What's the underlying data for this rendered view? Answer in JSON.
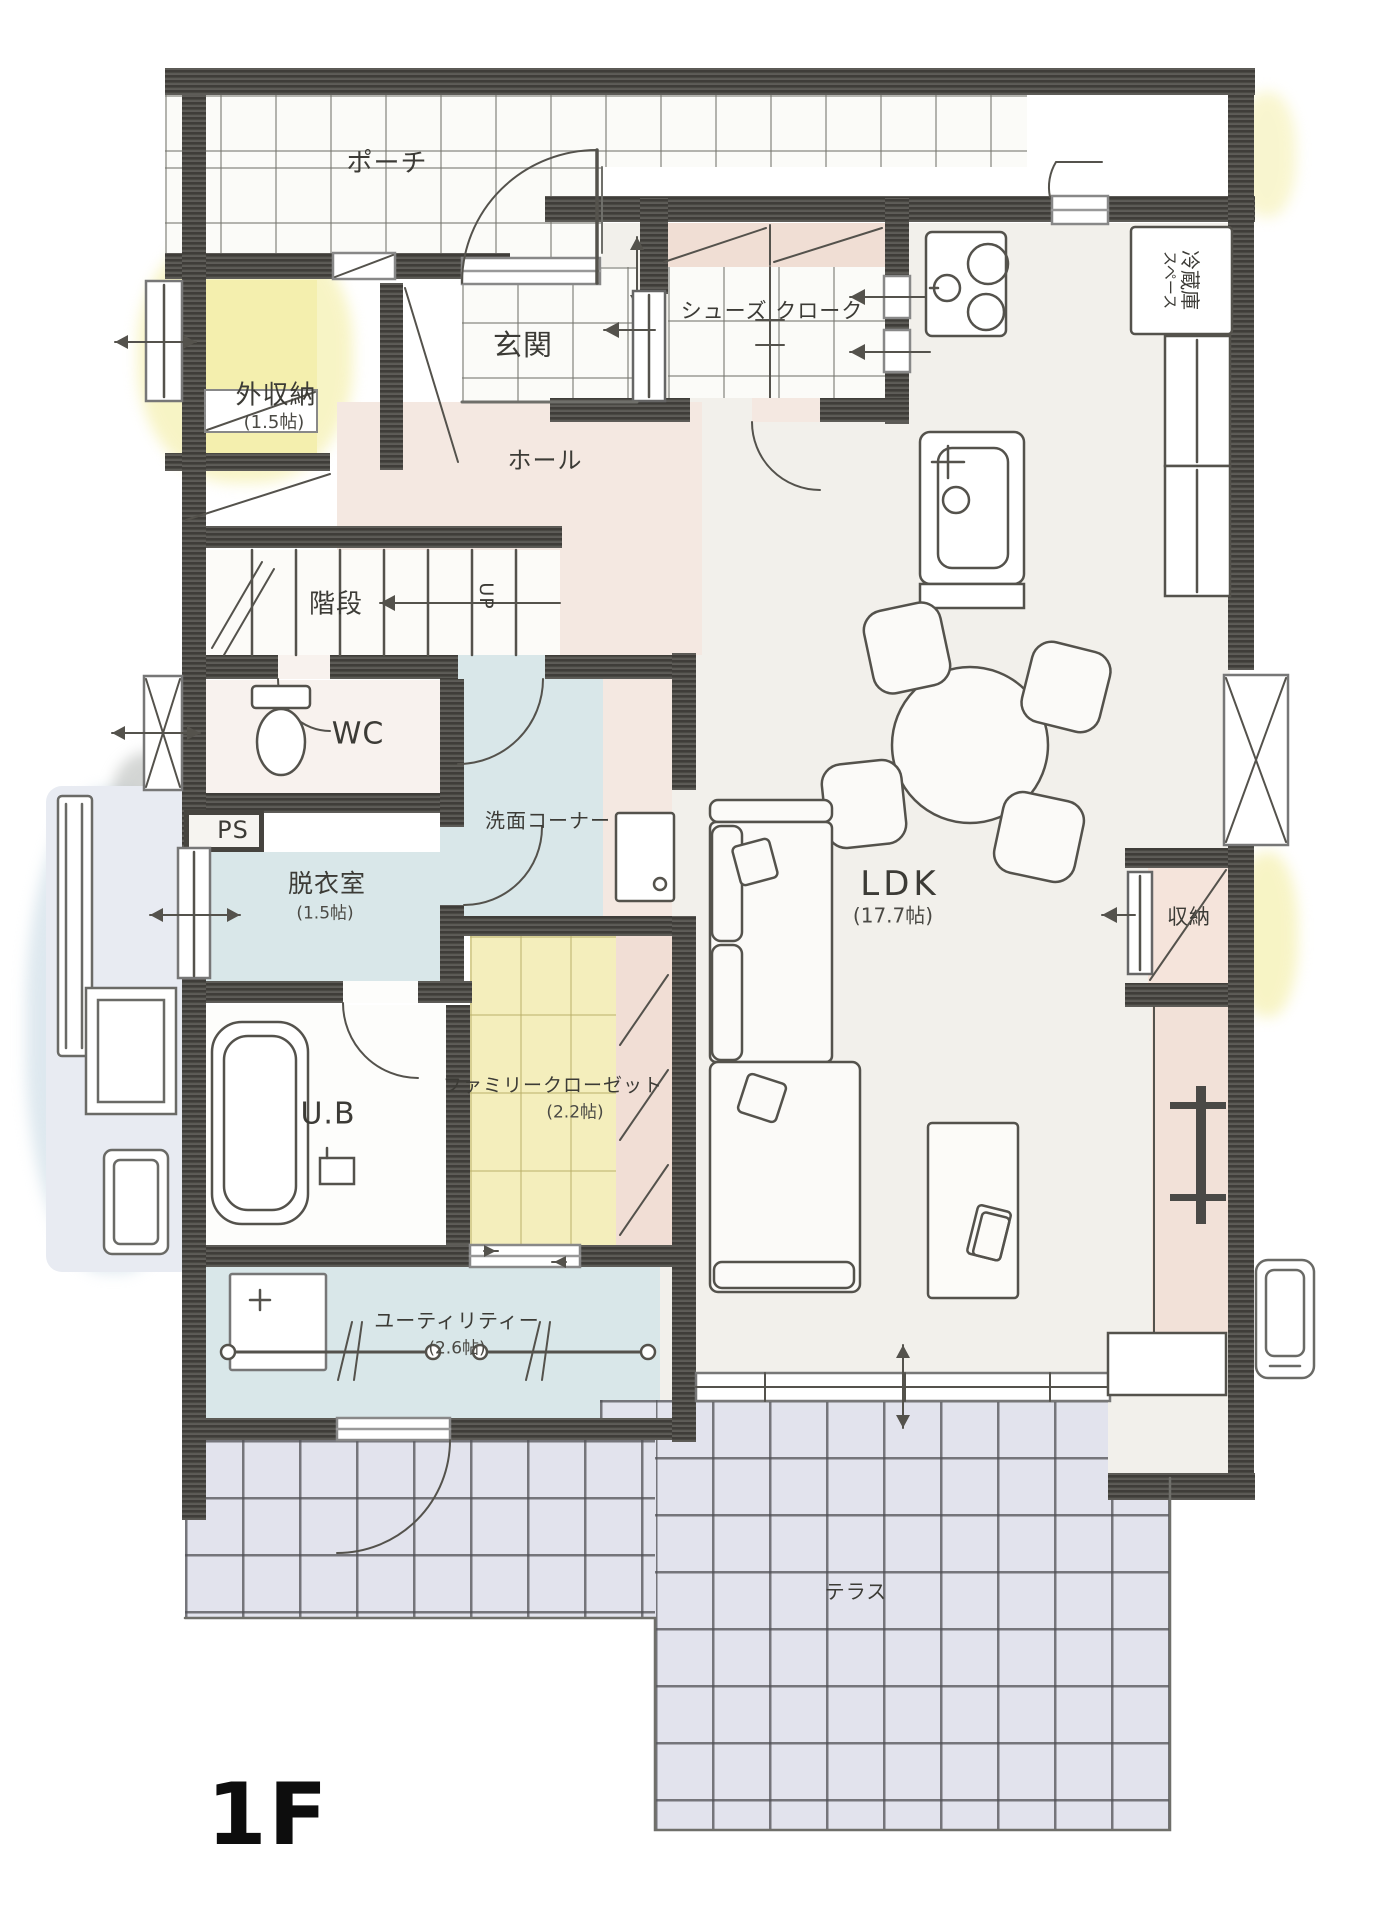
{
  "floor_label": "1F",
  "rooms": {
    "porch": {
      "label": "ポーチ"
    },
    "entrance": {
      "label": "玄関"
    },
    "shoe_closet": {
      "label": "シューズ クローク"
    },
    "exterior_storage": {
      "label": "外収納",
      "size": "(1.5帖)"
    },
    "hall": {
      "label": "ホール"
    },
    "stairs": {
      "label": "階段",
      "direction": "UP"
    },
    "wc": {
      "label": "WC"
    },
    "pipe_space": {
      "label": "PS"
    },
    "washroom_corner": {
      "label": "洗面コーナー"
    },
    "dressing_room": {
      "label": "脱衣室",
      "size": "(1.5帖)"
    },
    "unit_bath": {
      "label": "U.B"
    },
    "family_closet": {
      "label": "ファミリークローゼット",
      "size": "(2.2帖)"
    },
    "utility": {
      "label": "ユーティリティー",
      "size": "(2.6帖)"
    },
    "ldk": {
      "label": "LDK",
      "size": "(17.7帖)"
    },
    "storage": {
      "label": "収納"
    },
    "refrigerator_space": {
      "line1": "冷蔵庫",
      "line2": "スペース"
    },
    "terrace": {
      "label": "テラス"
    }
  },
  "colors": {
    "wall": "#46443f",
    "tile_blue": "#d9e7e9",
    "tile_yellow": "#f4eebc",
    "storage_yellow": "#f4efae",
    "floor_pink": "#f4e8e1",
    "shelf_pink": "#f0ded4",
    "board_pink": "#f2e1d8",
    "terrace": "#e2e3ed",
    "ldk_floor": "#f2f0eb",
    "line": "#54524c"
  }
}
